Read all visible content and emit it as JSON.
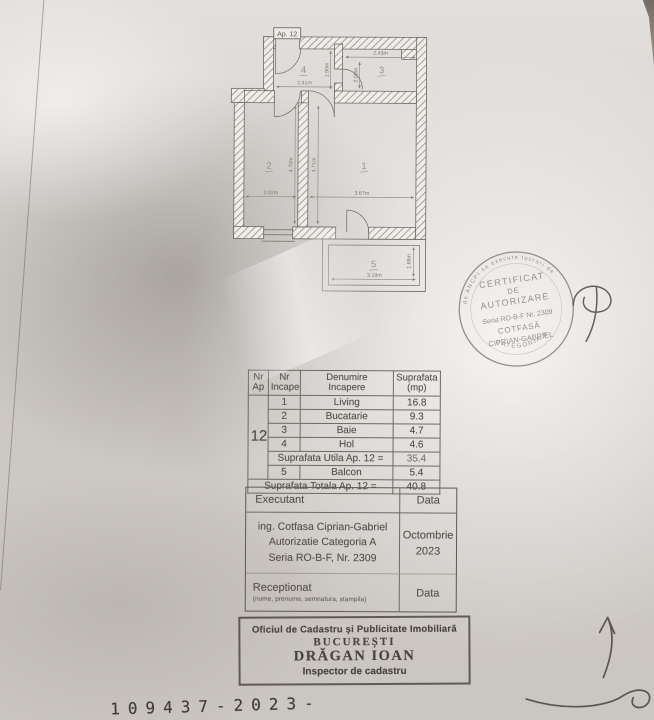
{
  "plan": {
    "apartment_label": "Ap. 12",
    "rooms": [
      {
        "n": "1"
      },
      {
        "n": "2"
      },
      {
        "n": "3"
      },
      {
        "n": "4"
      },
      {
        "n": "5"
      }
    ],
    "dims": {
      "room3_width": "2.43m",
      "hall_height": "1.90m",
      "room3_door": "2.08m",
      "room4_width": "2.41m",
      "room2_height": "4.70m",
      "room1_height": "4.71m",
      "room2_width": "2.02m",
      "room1_width": "3.67m",
      "balcony_width": "3.19m",
      "balcony_depth": "1.68m"
    }
  },
  "area_table": {
    "headers": {
      "col1_l1": "Nr",
      "col1_l2": "Ap",
      "col2_l1": "Nr",
      "col2_l2": "Incapere",
      "col3_l1": "Denumire",
      "col3_l2": "Incapere",
      "col4_l1": "Suprafata",
      "col4_l2": "(mp)"
    },
    "apartment_number": "12",
    "rows": [
      {
        "nr": "1",
        "name": "Living",
        "area": "16.8"
      },
      {
        "nr": "2",
        "name": "Bucatarie",
        "area": "9.3"
      },
      {
        "nr": "3",
        "name": "Baie",
        "area": "4.7"
      },
      {
        "nr": "4",
        "name": "Hol",
        "area": "4.6"
      }
    ],
    "useful_label": "Suprafata Utila Ap. 12 =",
    "useful_value": "35.4",
    "balcony_row": {
      "nr": "5",
      "name": "Balcon",
      "area": "5.4"
    },
    "total_label": "Suprafata Totala Ap. 12 =",
    "total_value": "40.8"
  },
  "exec_block": {
    "executant_label": "Executant",
    "data_label": "Data",
    "line1": "ing. Cotfasa Ciprian-Gabriel",
    "line2": "Autorizatie Categoria A",
    "line3": "Seria RO-B-F, Nr. 2309",
    "date": "Octombrie 2023",
    "receptionat_label": "Receptionat",
    "receptionat_note": "(nume, prenume, semnatura, stampila)",
    "receptionat_data_label": "Data"
  },
  "round_stamp": {
    "ring_top": "de ANCPI sa execute lucrari de",
    "ring_bottom": "CATEGORIA A",
    "line1": "CERTIFICAT",
    "line2": "DE",
    "line3": "AUTORIZARE",
    "serial": "Seria RO-B-F Nr. 2309",
    "name": "COTFASĂ",
    "name2": "CIPRIAN-GABRIEL"
  },
  "office_stamp": {
    "line1": "Oficiul de Cadastru și Publicitate Imobiliară",
    "line2": "BUCUREȘTI",
    "line3": "DRĂGAN IOAN",
    "line4": "Inspector de cadastru"
  },
  "registration_number": "109437-2023-",
  "colors": {
    "plan_ink": "#7b756f",
    "table_ink": "#57514b",
    "round_stamp_ink": "#857f79",
    "office_stamp_ink": "#423c36",
    "number_ink": "#403c38"
  }
}
